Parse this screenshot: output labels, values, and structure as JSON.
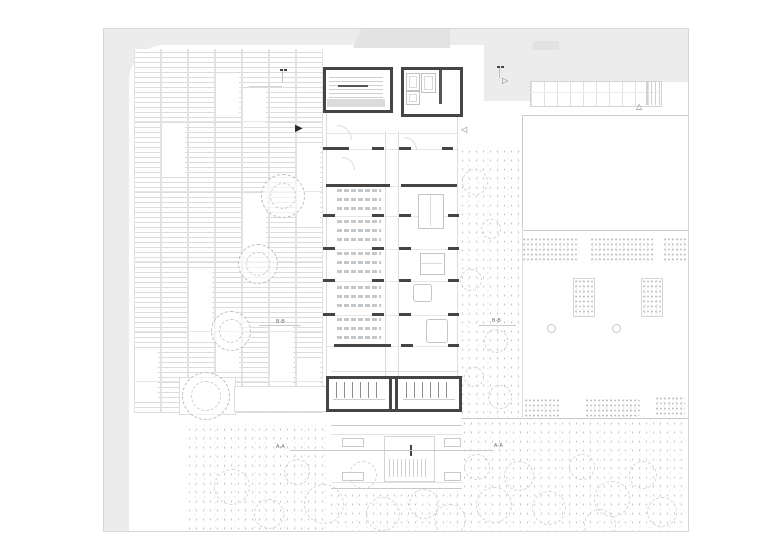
{
  "drawing": {
    "type": "architectural floor plan",
    "section_labels": {
      "aa": "A-A",
      "bb": "B-B"
    },
    "entry_markers": {
      "west_entry_filled": "▶",
      "east_entry_open": "◁",
      "north_path_open": "▷",
      "court_entry_open": "△"
    },
    "colors": {
      "paper": "#ffffff",
      "street_gray": "#ececec",
      "adjacent_roof_gray": "#e3e3e3",
      "wall_dark": "#454545",
      "drawing_line": "#c9c9c9",
      "stair_landing_gray": "#dbdbdb"
    }
  }
}
